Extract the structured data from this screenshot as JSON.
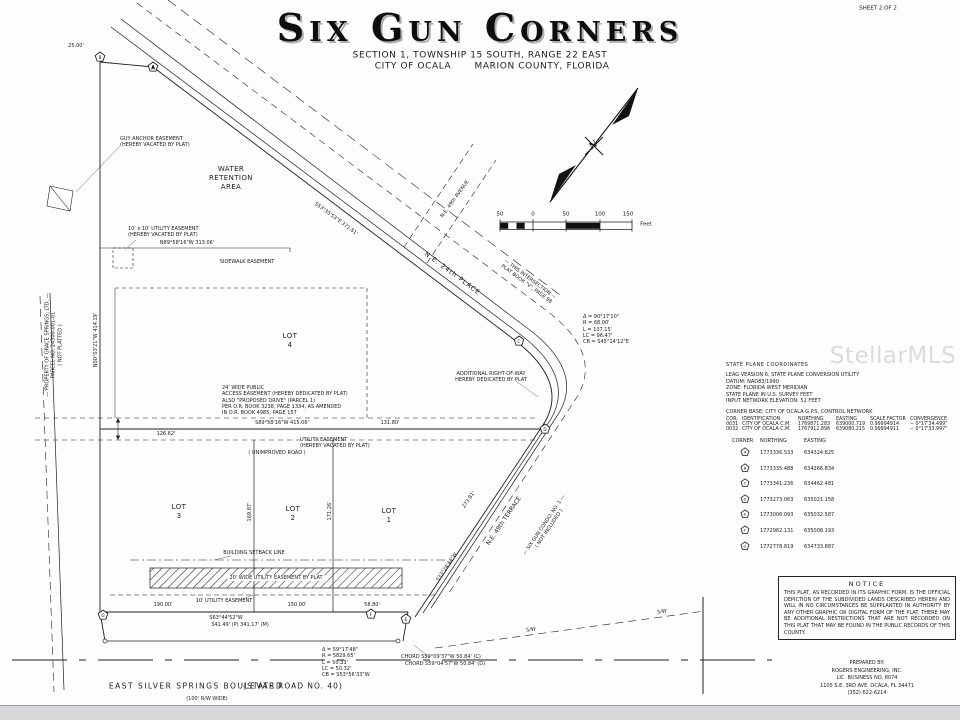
{
  "sheet_label": "SHEET 2 OF 2",
  "watermark": "StellarMLS",
  "title_block": {
    "title": "Six Gun Corners",
    "subtitle1": "SECTION 1, TOWNSHIP 15 SOUTH, RANGE 22 EAST",
    "subtitle2a": "CITY OF OCALA",
    "subtitle2b": "MARION COUNTY, FLORIDA"
  },
  "compass": {
    "n": "N"
  },
  "scale_bar": {
    "labels": [
      "50",
      "0",
      "50",
      "100",
      "150"
    ],
    "unit": "Feet"
  },
  "map": {
    "water": [
      "WATER",
      "RETENTION",
      "AREA"
    ],
    "lots": [
      {
        "label": "LOT",
        "number": "4"
      },
      {
        "label": "LOT",
        "number": "3"
      },
      {
        "label": "LOT",
        "number": "2"
      },
      {
        "label": "LOT",
        "number": "1"
      }
    ],
    "roads": {
      "ne24": "N.E. 24th PLACE",
      "ne49ave": "N.E. 49th AVENUE",
      "ne49ter": "N.E. 49th TERRACE",
      "blvd": "EAST SILVER SPRINGS BOULEVARD",
      "sr40": "(STATE ROAD NO. 40)",
      "rw": "(100' R/W WIDE)",
      "sw": "S/W"
    },
    "annotations": {
      "guy_anchor": [
        "GUY ANCHOR EASEMENT",
        "(HEREBY VACATED BY PLAT)"
      ],
      "util_vac_sm": [
        "10' x 10' UTILITY EASEMENT",
        "(HEREBY VACATED BY PLAT)"
      ],
      "sidewalk": "SIDEWALK EASEMENT",
      "access_note": [
        "24' WIDE PUBLIC",
        "ACCESS EASEMENT (HEREBY DEDICATED BY PLAT)",
        "ALSO \"PROPOSED DRIVE\" (PARCEL 1)",
        "PER O.R. BOOK 3238, PAGE 1334, AS AMENDED",
        "IN O.R. BOOK 4985, PAGE 157"
      ],
      "util_vac2": [
        "UTILITY EASEMENT",
        "(HEREBY VACATED BY PLAT)"
      ],
      "unimproved": "( UNIMPROVED ROAD )",
      "setback": "BUILDING SETBACK LINE",
      "hatch": "20' WIDE UTILITY EASEMENT BY PLAT",
      "util10": "10' UTILITY EASEMENT",
      "addl_rw": [
        "ADDITIONAL RIGHT-OF-WAY",
        "HEREBY DEDICATED BY PLAT"
      ],
      "intersection": [
        "— THIS INTERSECTION —",
        "PLAT BOOK \"V\", PAGE 98"
      ],
      "condo": [
        "— SIX GUN CONDO. NO. 1 —",
        "( NOT INCLUDED )"
      ],
      "grace": [
        "— PROPERTY OF GRACE SPRINGS, LTD. —",
        "PARCEL NO. 24300-001-01",
        "( NOT PLATTED )"
      ]
    },
    "dims": {
      "d313": "N89°58'16\"W  313.06'",
      "d415": "S89°58'16\"W  415.06'",
      "d131": "131.80'",
      "d126": "126.62'",
      "d190": "190.00'",
      "d150": "150.00'",
      "d58": "58.80'",
      "south_brg": "S63°44'52\"W",
      "south_len": "341.49' (P)  341.17' (M)",
      "west": "N00°03'21\"W  414.19'",
      "road": "S53°35'53\"E  371.81'",
      "d273": "273.81'",
      "d169": "169.87'",
      "d171": "171.26'",
      "d25": "25.00'",
      "after_brg": "S33°24'44\"W"
    },
    "curve1": [
      "Δ = 90°17'10\"",
      "R = 68.00'",
      "L = 107.15'",
      "LC = 96.47'",
      "CB = S45°14'12\"E"
    ],
    "curve2": [
      "Δ = 59°17'48\"",
      "R = 5829.65'",
      "L = 50.33'",
      "LC = 50.32'",
      "CB = S53°56'33\"W"
    ],
    "chords": [
      "CHORD S59°09'37\"W 50.84' (C)",
      "CHORD S59°04'57\"W 50.84' (D)"
    ]
  },
  "panel": {
    "title": "STATE PLANE COORDINATES",
    "info": [
      "LEAG VERSION 6, STATE PLANE CONVERSION UTILITY",
      "DATUM: NAD83/1990",
      "ZONE: FLORIDA WEST MERIDIAN",
      "STATE PLANE IN U.S. SURVEY FEET",
      "INPUT NETWORK ELEVATION: 52 FEET"
    ],
    "base": "CORNER BASE: CITY OF OCALA G.P.S. CONTROL NETWORK",
    "grid_header": [
      "COR.",
      "IDENTIFICATION",
      "NORTHING",
      "EASTING",
      "SCALE FACTOR",
      "CONVERGENCE"
    ],
    "grid_rows": [
      [
        "0031",
        "CITY OF OCALA C.M.",
        "1769871.283",
        "639000.719",
        "0.99994914",
        "− 0°17'34.499\""
      ],
      [
        "0032",
        "CITY OF OCALA C.M.",
        "1767912.898",
        "639080.215",
        "0.99994911",
        "− 0°17'33.997\""
      ]
    ],
    "corner_header": {
      "corner": "CORNER",
      "northing": "NORTHING",
      "easting": "EASTING"
    },
    "corners": [
      {
        "id": "A",
        "northing": "1773336.533",
        "easting": "634324.825"
      },
      {
        "id": "B",
        "northing": "1773335.488",
        "easting": "634266.834"
      },
      {
        "id": "C",
        "northing": "1773341.236",
        "easting": "634462.481"
      },
      {
        "id": "D",
        "northing": "1773273.063",
        "easting": "635021.158"
      },
      {
        "id": "E",
        "northing": "1773006.093",
        "easting": "635032.587"
      },
      {
        "id": "F",
        "northing": "1772982.131",
        "easting": "635008.193"
      },
      {
        "id": "G",
        "northing": "1772778.819",
        "easting": "634733.887"
      }
    ]
  },
  "notice": {
    "title": "NOTICE",
    "body": "THIS PLAT, AS RECORDED IN ITS GRAPHIC FORM, IS THE OFFICIAL DEPICTION OF THE SUBDIVIDED LANDS DESCRIBED HEREIN AND WILL IN NO CIRCUMSTANCES BE SUPPLANTED IN AUTHORITY BY ANY OTHER GRAPHIC OR DIGITAL FORM OF THE PLAT. THERE MAY BE ADDITIONAL RESTRICTIONS THAT ARE NOT RECORDED ON THIS PLAT THAT MAY BE FOUND IN THE PUBLIC RECORDS OF THIS COUNTY."
  },
  "prepared": [
    "PREPARED BY:",
    "ROGERS ENGINEERING, INC.",
    "LIC. BUSINESS NO. 8074",
    "1105 S.E. 3RD AVE.   OCALA, FL 34471",
    "(352) 622-6214"
  ]
}
